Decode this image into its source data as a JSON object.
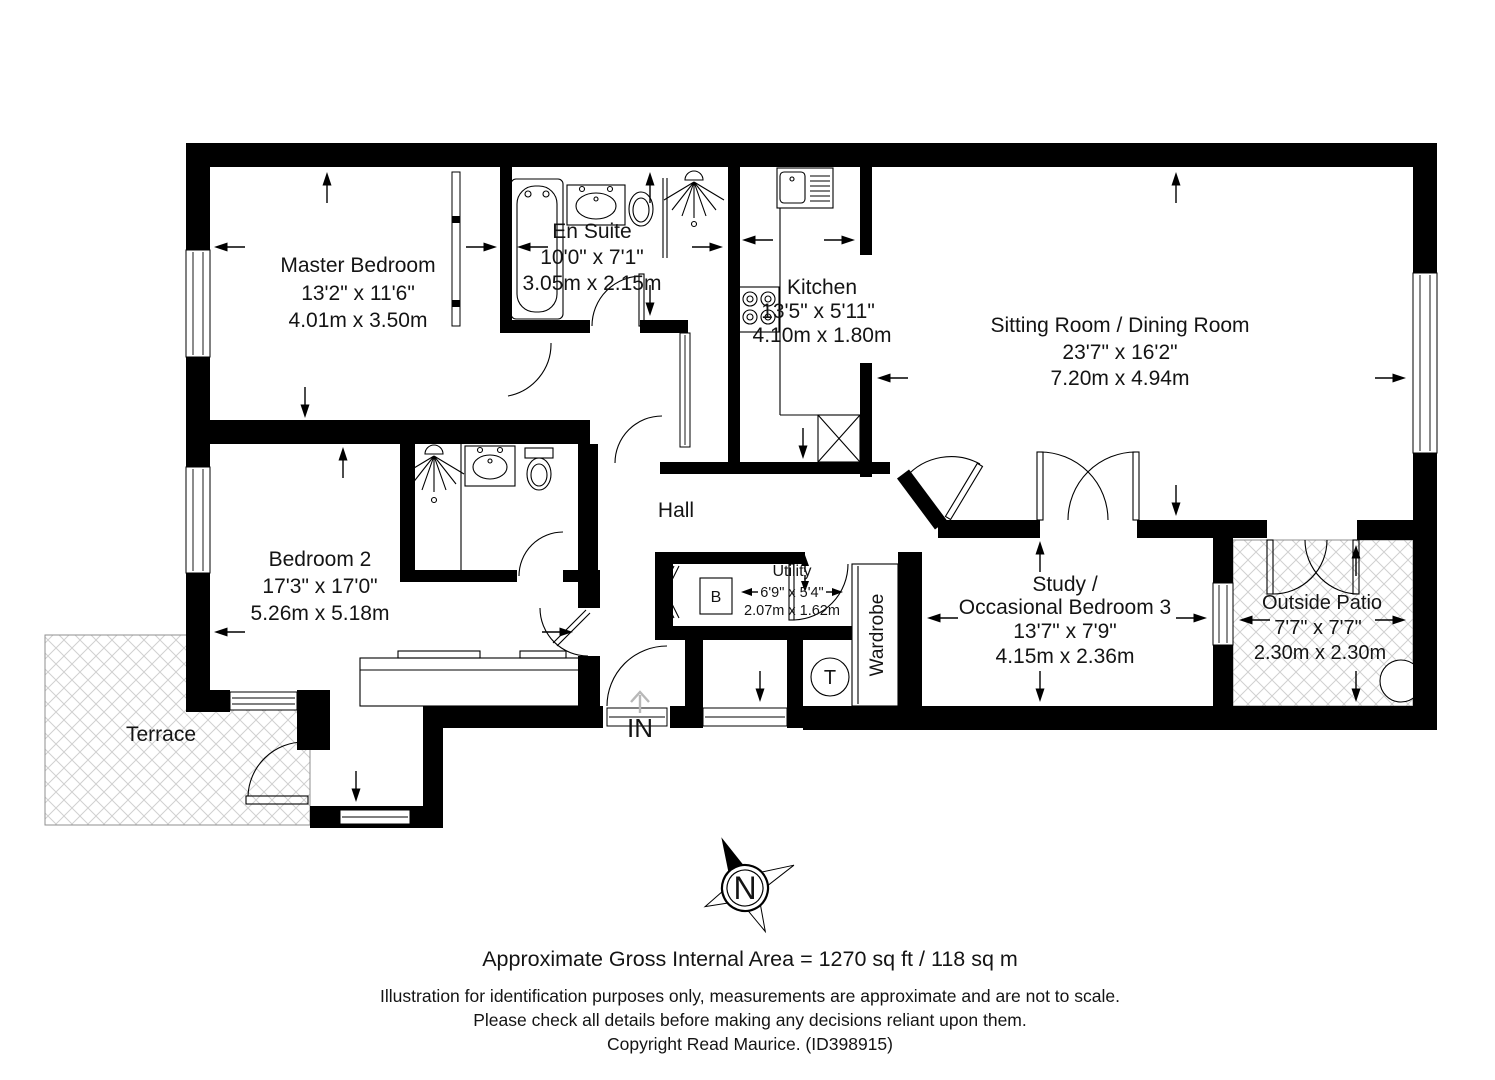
{
  "plan": {
    "rooms": [
      {
        "id": "master-bedroom",
        "name": "Master Bedroom",
        "dims_imperial": "13'2\" x 11'6\"",
        "dims_metric": "4.01m x 3.50m"
      },
      {
        "id": "en-suite",
        "name": "En Suite",
        "dims_imperial": "10'0\" x 7'1\"",
        "dims_metric": "3.05m x 2.15m"
      },
      {
        "id": "kitchen",
        "name": "Kitchen",
        "dims_imperial": "13'5\" x 5'11\"",
        "dims_metric": "4.10m x 1.80m"
      },
      {
        "id": "sitting-dining",
        "name": "Sitting Room / Dining Room",
        "dims_imperial": "23'7\" x 16'2\"",
        "dims_metric": "7.20m x 4.94m"
      },
      {
        "id": "bedroom-2",
        "name": "Bedroom 2",
        "dims_imperial": "17'3\" x 17'0\"",
        "dims_metric": "5.26m x 5.18m"
      },
      {
        "id": "hall",
        "name": "Hall"
      },
      {
        "id": "utility",
        "name": "Utility",
        "dims_imperial": "6'9\" x 5'4\"",
        "dims_metric": "2.07m x 1.62m"
      },
      {
        "id": "wardrobe",
        "name": "Wardrobe"
      },
      {
        "id": "study",
        "name_line1": "Study /",
        "name_line2": "Occasional Bedroom 3",
        "dims_imperial": "13'7\" x 7'9\"",
        "dims_metric": "4.15m x 2.36m"
      },
      {
        "id": "outside-patio",
        "name": "Outside Patio",
        "dims_imperial": "7'7\" x 7'7\"",
        "dims_metric": "2.30m x 2.30m"
      },
      {
        "id": "terrace",
        "name": "Terrace"
      }
    ],
    "labels": {
      "entrance": "IN",
      "boiler": "B",
      "tank": "T",
      "compass_north": "N"
    }
  },
  "footer": {
    "area_summary": "Approximate Gross Internal Area = 1270 sq ft / 118 sq m",
    "disclaimer_line1": "Illustration for identification purposes only, measurements are approximate and are not to scale.",
    "disclaimer_line2": "Please check all details before making any decisions reliant upon them.",
    "copyright": "Copyright Read Maurice. (ID398915)"
  },
  "colors": {
    "wall": "#000000",
    "background": "#ffffff",
    "hatch_line": "#d0d0d0",
    "ghost_arrow": "#b8b8b8"
  }
}
